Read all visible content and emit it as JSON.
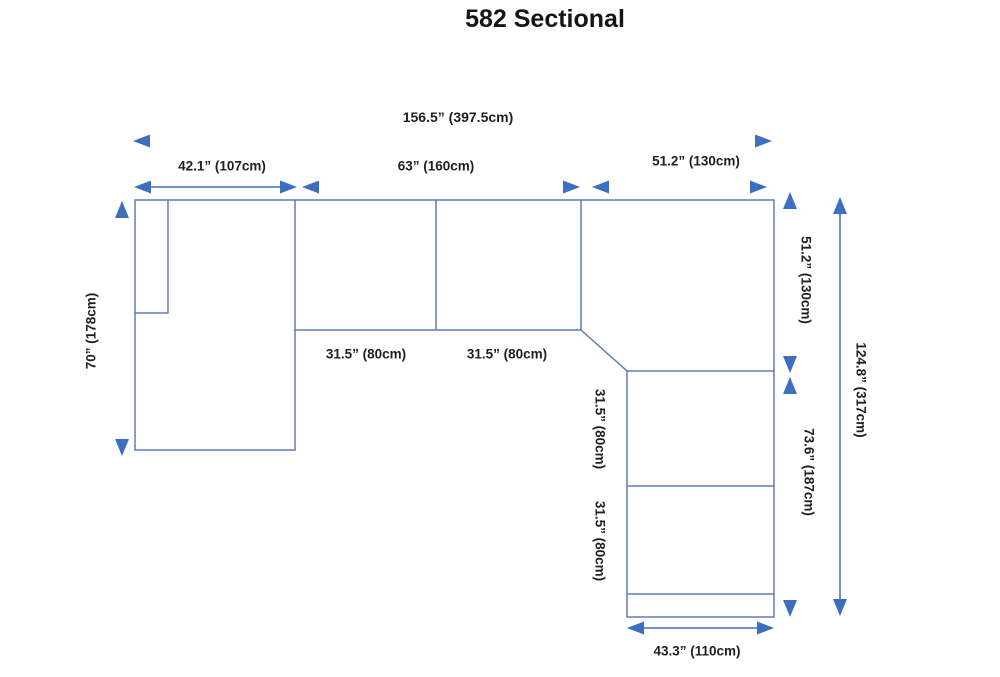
{
  "title": "582 Sectional",
  "colors": {
    "outline": "#5d7db8",
    "dimension_accent": "#3d6ebf",
    "text": "#1f1f1f",
    "background": "#ffffff"
  },
  "icons": {
    "arrow_style": "filled-triangle-arrowhead"
  },
  "labels": {
    "overall_width": "156.5” (397.5cm)",
    "chaise_width": "42.1” (107cm)",
    "middle_width": "63” (160cm)",
    "corner_width": "51.2” (130cm)",
    "left_height": "70” (178cm)",
    "right_upper_height": "51.2” (130cm)",
    "right_lower_height": "73.6” (187cm)",
    "overall_height": "124.8” (317cm)",
    "middle_seat_1_width": "31.5” (80cm)",
    "middle_seat_2_width": "31.5” (80cm)",
    "right_seat_1_height": "31.5” (80cm)",
    "right_seat_2_height": "31.5” (80cm)",
    "bottom_width": "43.3” (110cm)"
  }
}
